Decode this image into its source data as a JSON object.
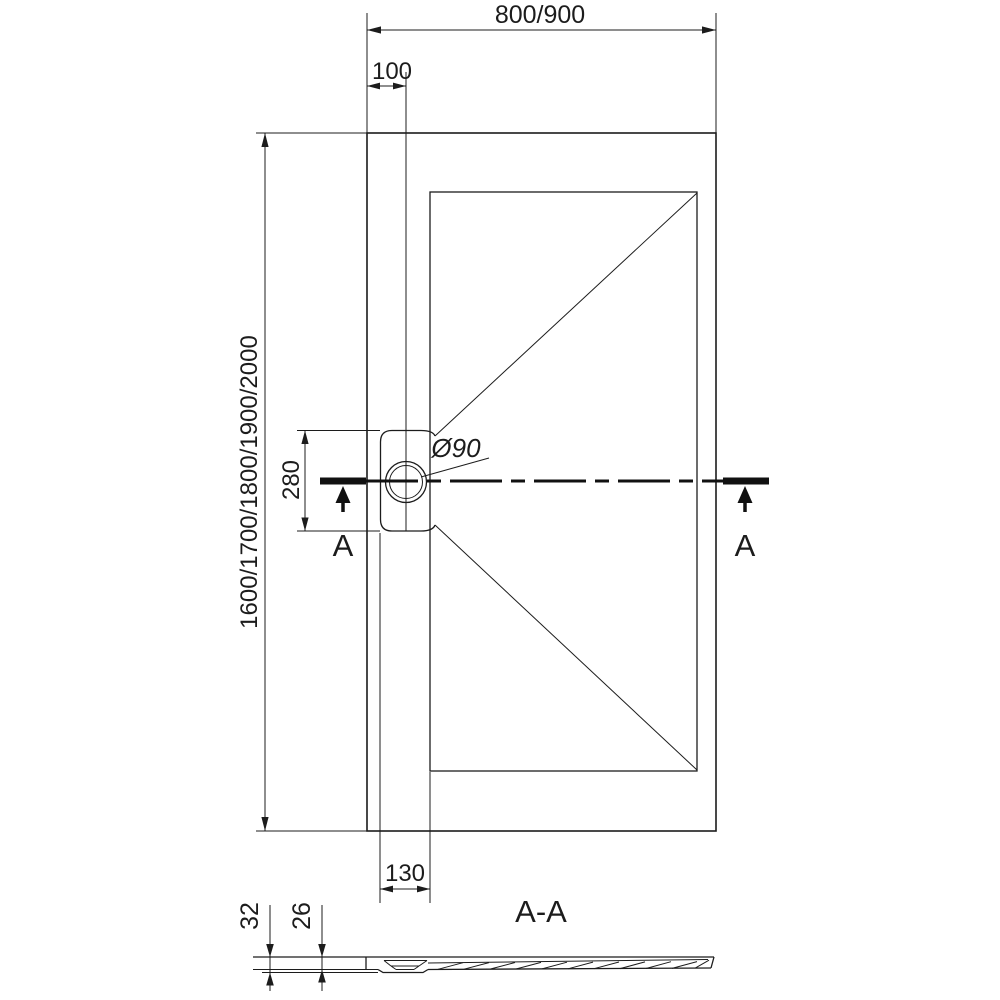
{
  "meta": {
    "drawing_type": "shower-tray-dimension-drawing",
    "ink_color": "#1c1c1c",
    "background_color": "#ffffff"
  },
  "top_view": {
    "width_label": "800/900",
    "drain_offset_label": "100",
    "length_label": "1600/1700/1800/1900/2000",
    "drain_cutout_length_label": "280",
    "drain_diameter_label": "Ø90",
    "drain_cutout_width_label": "130",
    "cut_marker_left": "A",
    "cut_marker_right": "A"
  },
  "section_view": {
    "title": "A-A",
    "total_height_label": "32",
    "base_height_label": "26"
  }
}
